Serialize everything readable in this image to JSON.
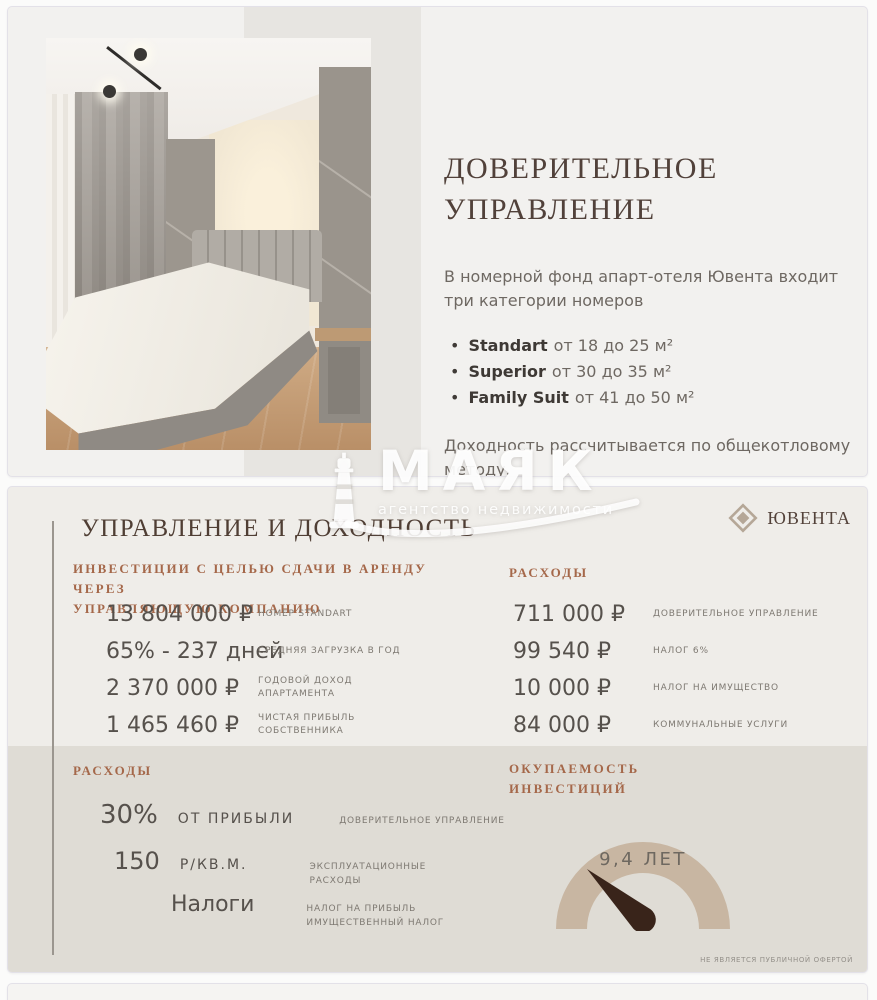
{
  "slide1": {
    "title": "ДОВЕРИТЕЛЬНОЕ\nУПРАВЛЕНИЕ",
    "intro": "В номерной фонд апарт-отеля Ювента входит три категории номеров",
    "bullets": [
      {
        "name": "Standart",
        "rest": "от 18 до 25 м²"
      },
      {
        "name": "Superior",
        "rest": "от 30 до 35 м²"
      },
      {
        "name": "Family Suit",
        "rest": "от 41 до 50 м²"
      }
    ],
    "note": "Доходность рассчитывается по общекотловому методу."
  },
  "watermark": {
    "name": "МАЯК",
    "tagline": "агентство недвижимости"
  },
  "slide2": {
    "brand": "ЮВЕНТА",
    "heading": "УПРАВЛЕНИЕ И ДОХОДНОСТЬ",
    "invest_section": {
      "title": "ИНВЕСТИЦИИ С ЦЕЛЬЮ СДАЧИ В АРЕНДУ ЧЕРЕЗ\nУПРАВЛЯЮЩУЮ КОМПАНИЮ",
      "rows": [
        {
          "value": "13 804 000  ₽",
          "label": "НОМЕР STANDART"
        },
        {
          "value": "65% - 237 дней",
          "label": "СРЕДНЯЯ ЗАГРУЗКА В ГОД"
        },
        {
          "value": "2 370 000 ₽",
          "label": "ГОДОВОЙ ДОХОД\nАПАРТАМЕНТА"
        },
        {
          "value": "1 465 460 ₽",
          "label": "ЧИСТАЯ ПРИБЫЛЬ\nСОБСТВЕННИКА"
        }
      ]
    },
    "expenses_section": {
      "title": "РАСХОДЫ",
      "rows": [
        {
          "value": "711 000 ₽",
          "label": "ДОВЕРИТЕЛЬНОЕ УПРАВЛЕНИЕ"
        },
        {
          "value": "99 540 ₽",
          "label": "НАЛОГ 6%"
        },
        {
          "value": "10 000 ₽",
          "label": "НАЛОГ НА ИМУЩЕСТВО"
        },
        {
          "value": "84 000 ₽",
          "label": "КОММУНАЛЬНЫЕ УСЛУГИ"
        }
      ]
    },
    "costs_section": {
      "title": "РАСХОДЫ",
      "rows": [
        {
          "value": "30%",
          "unit": "ОТ ПРИБЫЛИ",
          "label": "ДОВЕРИТЕЛЬНОЕ УПРАВЛЕНИЕ"
        },
        {
          "value": "150",
          "unit": "Р/КВ.М.",
          "label": "ЭКСПЛУАТАЦИОННЫЕ\nРАСХОДЫ"
        },
        {
          "value": "Налоги",
          "unit": "",
          "label": "НАЛОГ НА ПРИБЫЛЬ\nИМУЩЕСТВЕННЫЙ НАЛОГ"
        }
      ]
    },
    "payback_section": {
      "title": "ОКУПАЕМОСТЬ\nИНВЕСТИЦИЙ",
      "gauge_value": "9,4 ЛЕТ"
    },
    "disclaimer": "НЕ ЯВЛЯЕТСЯ ПУБЛИЧНОЙ ОФЕРТОЙ"
  },
  "colors": {
    "accent_rust": "#a5684a",
    "heading_brown": "#4f3e34",
    "gauge_arc": "#c8b6a2",
    "gauge_needle": "#39241a",
    "brand_diamond": "#b5a797"
  }
}
